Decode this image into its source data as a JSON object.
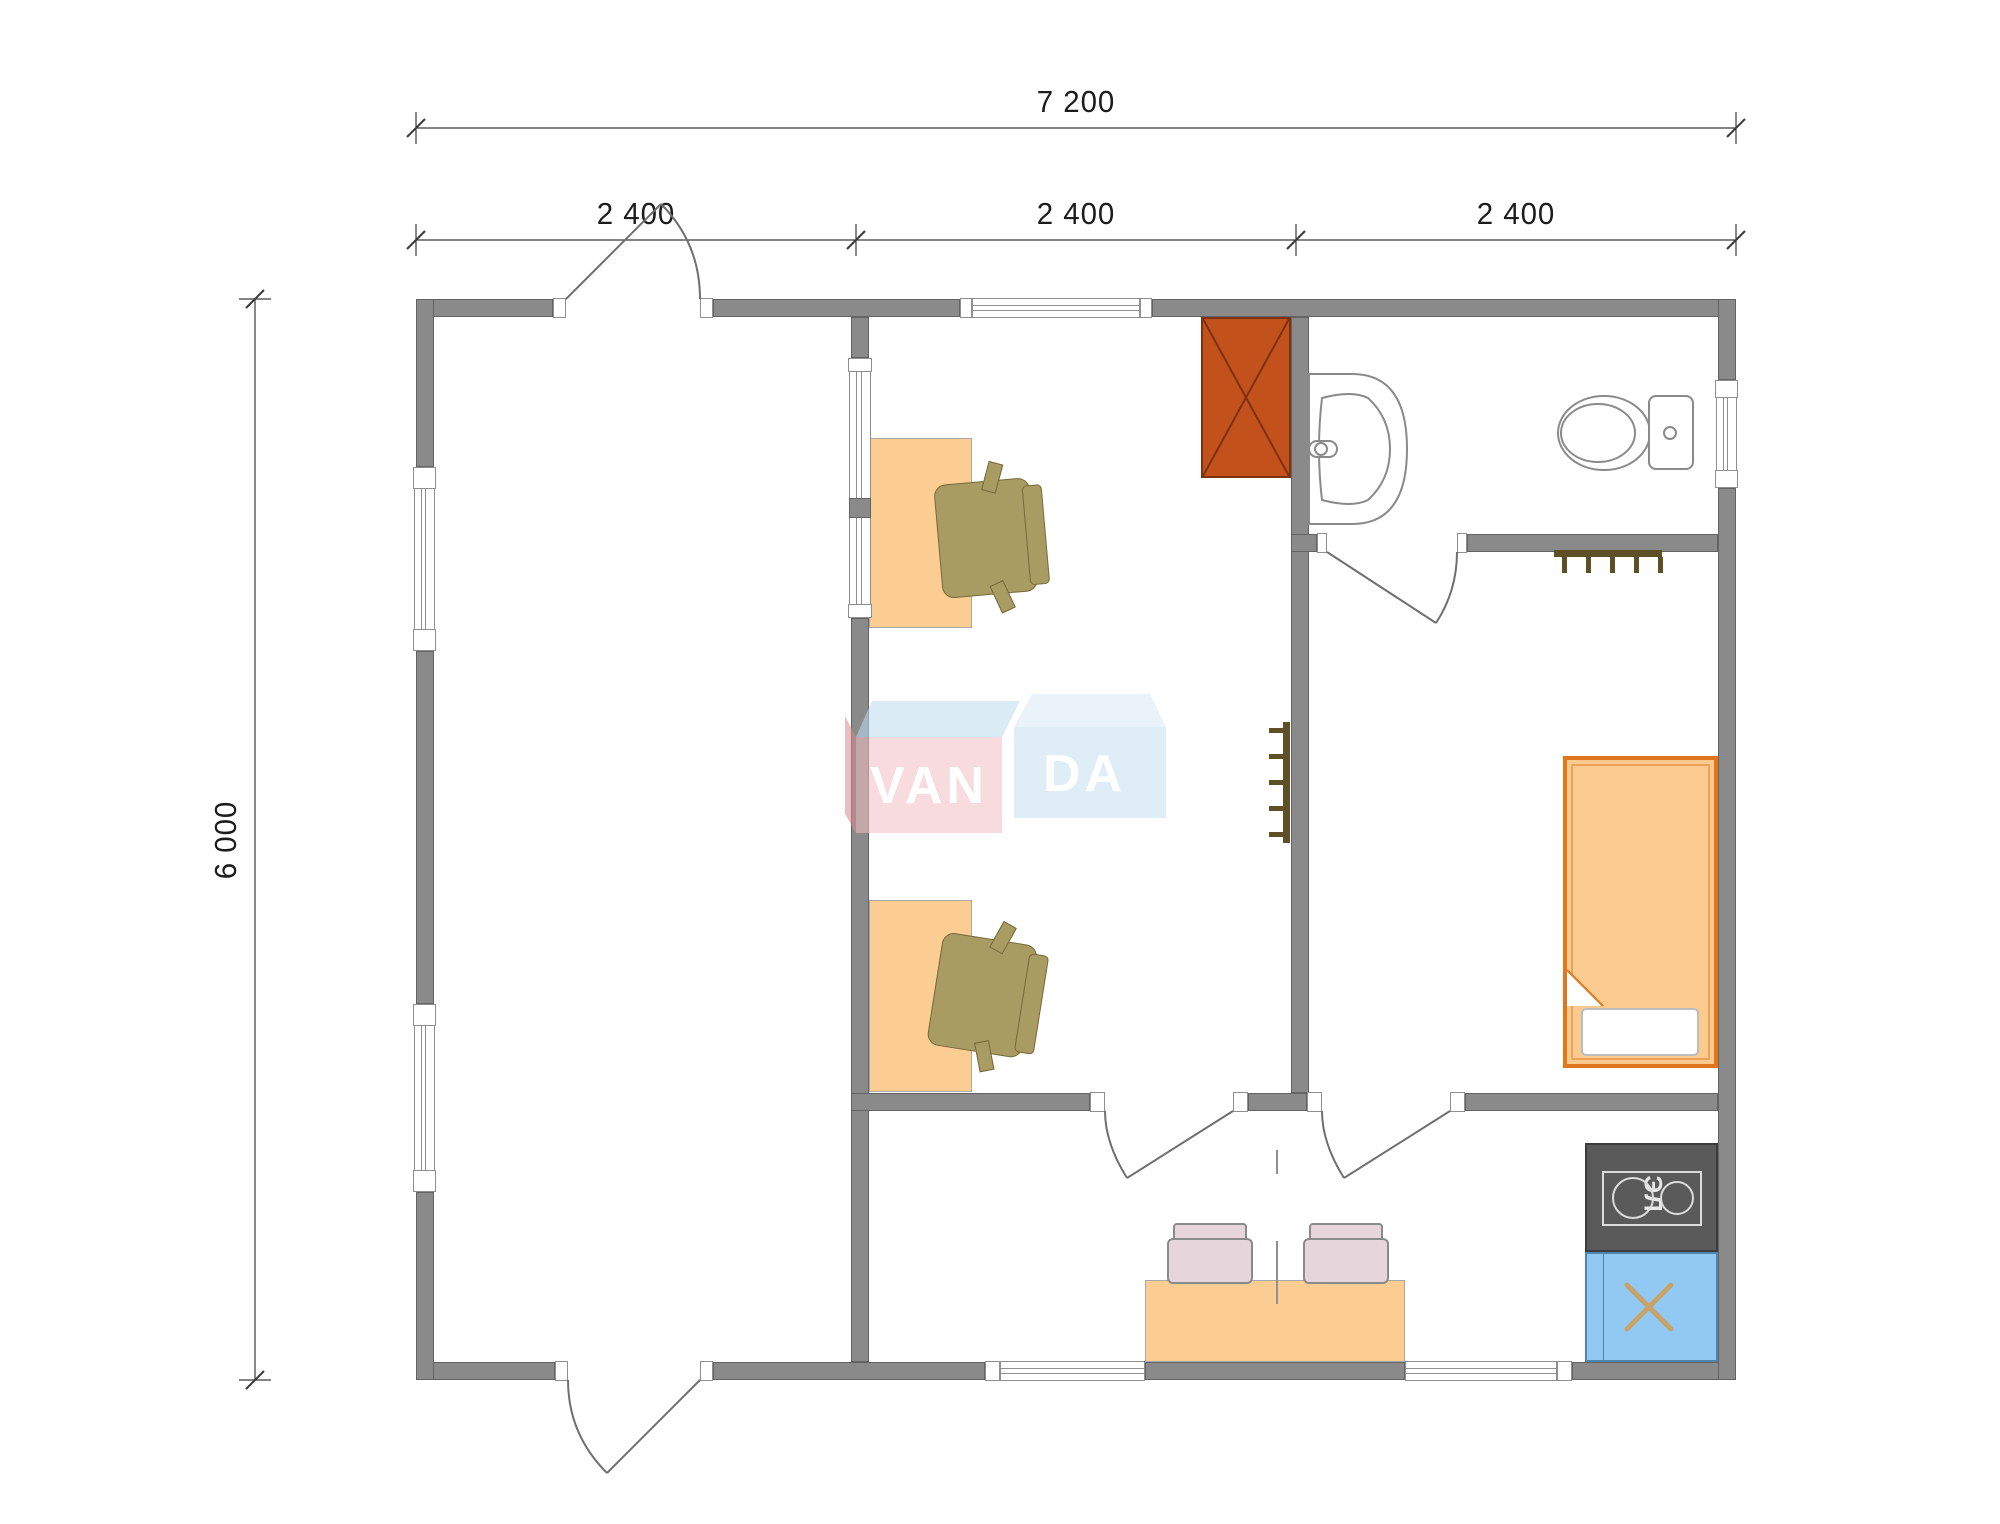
{
  "dimensions": {
    "overall_width_label": "7 200",
    "modules": [
      "2 400",
      "2 400",
      "2 400"
    ],
    "overall_depth_label": "6 000"
  },
  "watermark": {
    "box_left_text": "VAN",
    "box_right_text": "DA"
  },
  "kitchen": {
    "stove_label": "ЭЛ"
  },
  "colors": {
    "wall": "#8A8A8A",
    "desk": "#FBCD92",
    "office_chair": "#A99C62",
    "wardrobe": "#C2511B",
    "bed_border": "#E1761F",
    "bed_fill": "#FBCA8E",
    "dining_chair": "#E7D5DC",
    "stove": "#5A5A5A",
    "sink_counter": "#92C9F3",
    "sink_cross": "#C8A266",
    "logo_left_box": "#F3BFC4",
    "logo_right_box": "#C6E0F2"
  }
}
